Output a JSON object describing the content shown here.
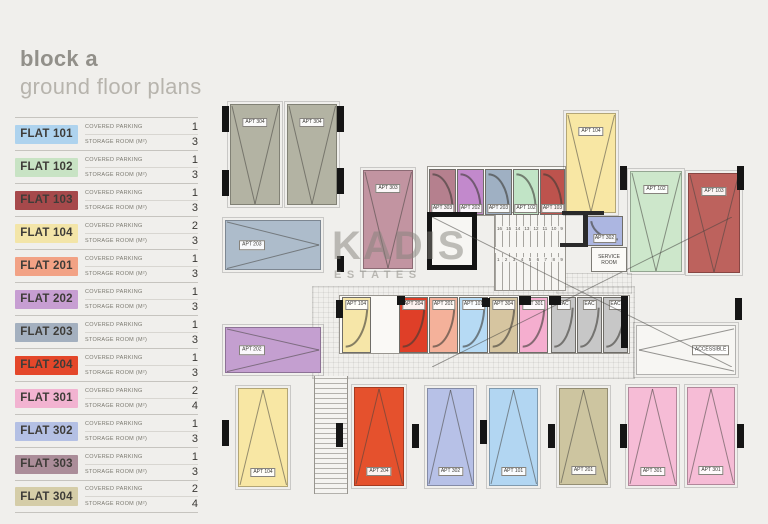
{
  "header": {
    "title_line1": "block a",
    "title_line2": "ground floor plans"
  },
  "watermark": {
    "line1": "KADIS",
    "line2": "ESTATES"
  },
  "legend": {
    "covered_parking_label": "COVERED PARKING",
    "storage_room_label": "STORAGE ROOM (M²)",
    "flats": [
      {
        "name": "FLAT 101",
        "color": "#aed3ee",
        "covered_parking": "1",
        "storage_room": "3"
      },
      {
        "name": "FLAT 102",
        "color": "#c8e3c4",
        "covered_parking": "1",
        "storage_room": "3"
      },
      {
        "name": "FLAT 103",
        "color": "#a6494b",
        "covered_parking": "1",
        "storage_room": "3"
      },
      {
        "name": "FLAT 104",
        "color": "#f3e5a8",
        "covered_parking": "2",
        "storage_room": "3"
      },
      {
        "name": "FLAT 201",
        "color": "#f2a285",
        "covered_parking": "1",
        "storage_room": "3"
      },
      {
        "name": "FLAT 202",
        "color": "#c79ed2",
        "covered_parking": "1",
        "storage_room": "3"
      },
      {
        "name": "FLAT 203",
        "color": "#a4b0bf",
        "covered_parking": "1",
        "storage_room": "3"
      },
      {
        "name": "FLAT 204",
        "color": "#e4472a",
        "covered_parking": "1",
        "storage_room": "3"
      },
      {
        "name": "FLAT 301",
        "color": "#f2b3d1",
        "covered_parking": "2",
        "storage_room": "4"
      },
      {
        "name": "FLAT 302",
        "color": "#b4c0e4",
        "covered_parking": "1",
        "storage_room": "3"
      },
      {
        "name": "FLAT 303",
        "color": "#ab8d99",
        "covered_parking": "1",
        "storage_room": "3"
      },
      {
        "name": "FLAT 304",
        "color": "#d5cda8",
        "covered_parking": "2",
        "storage_room": "4"
      }
    ]
  },
  "plan": {
    "units": [
      {
        "label": "APT 304",
        "type": "parking-v-top",
        "color": "#b3b3a3",
        "x": 230,
        "y": 104,
        "w": 50,
        "h": 101
      },
      {
        "label": "APT 304",
        "type": "parking-v-top",
        "color": "#b3b3a3",
        "x": 287,
        "y": 104,
        "w": 50,
        "h": 101
      },
      {
        "label": "APT 104",
        "type": "parking-v-top",
        "color": "#f8e7a4",
        "x": 566,
        "y": 113,
        "w": 50,
        "h": 100
      },
      {
        "label": "APT 303",
        "type": "parking-v-top",
        "color": "#c294a1",
        "x": 363,
        "y": 170,
        "w": 50,
        "h": 99
      },
      {
        "label": "APT 102",
        "type": "parking-v-top",
        "color": "#cde7cb",
        "x": 630,
        "y": 171,
        "w": 52,
        "h": 101
      },
      {
        "label": "APT 103",
        "type": "parking-v-top",
        "color": "#bd625d",
        "x": 688,
        "y": 173,
        "w": 52,
        "h": 100
      },
      {
        "label": "APT 203",
        "type": "parking-h",
        "color": "#adbccb",
        "x": 225,
        "y": 220,
        "w": 96,
        "h": 50
      },
      {
        "label": "APT 202",
        "type": "parking-h",
        "color": "#c49fd0",
        "x": 225,
        "y": 327,
        "w": 96,
        "h": 46
      },
      {
        "label": "APT 104",
        "type": "parking-v-bottom",
        "color": "#f8e7a4",
        "x": 238,
        "y": 388,
        "w": 50,
        "h": 99
      },
      {
        "label": "APT 204",
        "type": "parking-v-bottom",
        "color": "#e5512d",
        "x": 354,
        "y": 387,
        "w": 50,
        "h": 99
      },
      {
        "label": "APT 302",
        "type": "parking-v-bottom",
        "color": "#b7c1e7",
        "x": 427,
        "y": 388,
        "w": 47,
        "h": 98
      },
      {
        "label": "APT 101",
        "type": "parking-v-bottom",
        "color": "#b2d6f2",
        "x": 489,
        "y": 388,
        "w": 49,
        "h": 98
      },
      {
        "label": "APT 201",
        "type": "parking-v-bottom",
        "color": "#cdc5a0",
        "x": 559,
        "y": 388,
        "w": 49,
        "h": 97
      },
      {
        "label": "APT 301",
        "type": "parking-v-bottom",
        "color": "#f6bcd6",
        "x": 628,
        "y": 387,
        "w": 49,
        "h": 99
      },
      {
        "label": "APT 301",
        "type": "parking-v-bottom",
        "color": "#f6bcd6",
        "x": 687,
        "y": 387,
        "w": 48,
        "h": 98
      },
      {
        "label": "ACCESSIBLE",
        "type": "accessible",
        "color": "#f7f6f3",
        "x": 636,
        "y": 325,
        "w": 100,
        "h": 50
      },
      {
        "label": "APT 303",
        "type": "storage-top",
        "color": "#b5808e",
        "x": 429,
        "y": 169,
        "w": 27,
        "h": 46
      },
      {
        "label": "APT 202",
        "type": "storage-top",
        "color": "#c289cc",
        "x": 457,
        "y": 169,
        "w": 27,
        "h": 46
      },
      {
        "label": "APT 203",
        "type": "storage-top",
        "color": "#9fb0c3",
        "x": 485,
        "y": 169,
        "w": 27,
        "h": 46
      },
      {
        "label": "APT 102",
        "type": "storage-top",
        "color": "#c1e4c6",
        "x": 513,
        "y": 169,
        "w": 26,
        "h": 46
      },
      {
        "label": "APT 103",
        "type": "storage-top",
        "color": "#bd534d",
        "x": 540,
        "y": 169,
        "w": 25,
        "h": 46
      },
      {
        "label": "APT 104",
        "type": "storage-bottom",
        "color": "#f6e6a8",
        "x": 342,
        "y": 297,
        "w": 29,
        "h": 56
      },
      {
        "label": "APT 204",
        "type": "storage-bottom",
        "color": "#df3f28",
        "x": 399,
        "y": 297,
        "w": 29,
        "h": 56
      },
      {
        "label": "APT 201",
        "type": "storage-bottom",
        "color": "#f4b19a",
        "x": 429,
        "y": 297,
        "w": 29,
        "h": 56
      },
      {
        "label": "APT 101",
        "type": "storage-bottom",
        "color": "#b6daf4",
        "x": 459,
        "y": 297,
        "w": 29,
        "h": 56
      },
      {
        "label": "APT 304",
        "type": "storage-bottom",
        "color": "#d6c5a0",
        "x": 489,
        "y": 297,
        "w": 29,
        "h": 56
      },
      {
        "label": "APT 301",
        "type": "storage-bottom",
        "color": "#f5aecf",
        "x": 519,
        "y": 297,
        "w": 29,
        "h": 56
      },
      {
        "label": "EAC",
        "type": "storage-bottom",
        "color": "#c7c7c7",
        "x": 551,
        "y": 297,
        "w": 25,
        "h": 56
      },
      {
        "label": "EAC",
        "type": "storage-bottom",
        "color": "#c7c7c7",
        "x": 577,
        "y": 297,
        "w": 25,
        "h": 56
      },
      {
        "label": "EAC",
        "type": "storage-bottom",
        "color": "#c7c7c7",
        "x": 603,
        "y": 297,
        "w": 25,
        "h": 56
      },
      {
        "label": "APT 302",
        "type": "storage-plain",
        "color": "#acb6e1",
        "x": 586,
        "y": 216,
        "w": 37,
        "h": 30
      }
    ],
    "service_room": {
      "label": "SERVICE ROOM",
      "x": 591,
      "y": 247,
      "w": 36,
      "h": 25
    },
    "elevator": {
      "x": 427,
      "y": 212,
      "w": 50,
      "h": 58
    },
    "stairs": {
      "x": 494,
      "y": 212,
      "w": 72,
      "h": 79,
      "numbers_top": "16 15 14 13 12 11 10 9",
      "numbers_bottom": "1 2 3 4 5 6 7 8 9"
    },
    "ramp": {
      "x": 314,
      "y": 376,
      "w": 32,
      "h": 118
    },
    "backdrops": [
      {
        "x": 427,
        "y": 166,
        "w": 139,
        "h": 50
      },
      {
        "x": 339,
        "y": 295,
        "w": 291,
        "h": 59
      }
    ],
    "hatches": [
      {
        "x": 312,
        "y": 286,
        "w": 321,
        "h": 91
      },
      {
        "x": 556,
        "y": 273,
        "w": 74,
        "h": 19
      }
    ],
    "columns": [
      {
        "x": 222,
        "y": 106,
        "w": 7,
        "h": 26
      },
      {
        "x": 222,
        "y": 170,
        "w": 7,
        "h": 26
      },
      {
        "x": 337,
        "y": 106,
        "w": 7,
        "h": 26
      },
      {
        "x": 337,
        "y": 168,
        "w": 7,
        "h": 26
      },
      {
        "x": 337,
        "y": 256,
        "w": 7,
        "h": 16
      },
      {
        "x": 620,
        "y": 166,
        "w": 7,
        "h": 24
      },
      {
        "x": 737,
        "y": 166,
        "w": 7,
        "h": 24
      },
      {
        "x": 735,
        "y": 298,
        "w": 7,
        "h": 22
      },
      {
        "x": 222,
        "y": 420,
        "w": 7,
        "h": 26
      },
      {
        "x": 336,
        "y": 423,
        "w": 7,
        "h": 24
      },
      {
        "x": 412,
        "y": 424,
        "w": 7,
        "h": 24
      },
      {
        "x": 480,
        "y": 420,
        "w": 7,
        "h": 24
      },
      {
        "x": 548,
        "y": 424,
        "w": 7,
        "h": 24
      },
      {
        "x": 620,
        "y": 424,
        "w": 7,
        "h": 24
      },
      {
        "x": 737,
        "y": 424,
        "w": 7,
        "h": 24
      },
      {
        "x": 336,
        "y": 300,
        "w": 7,
        "h": 18
      },
      {
        "x": 397,
        "y": 296,
        "w": 8,
        "h": 9
      },
      {
        "x": 482,
        "y": 298,
        "w": 8,
        "h": 9
      },
      {
        "x": 519,
        "y": 296,
        "w": 12,
        "h": 9
      },
      {
        "x": 549,
        "y": 296,
        "w": 12,
        "h": 9
      },
      {
        "x": 621,
        "y": 296,
        "w": 7,
        "h": 52
      }
    ],
    "walls": [
      {
        "x": 562,
        "y": 211,
        "w": 42,
        "h": 4
      },
      {
        "x": 583,
        "y": 211,
        "w": 5,
        "h": 35
      },
      {
        "x": 560,
        "y": 243,
        "w": 28,
        "h": 4
      }
    ]
  }
}
